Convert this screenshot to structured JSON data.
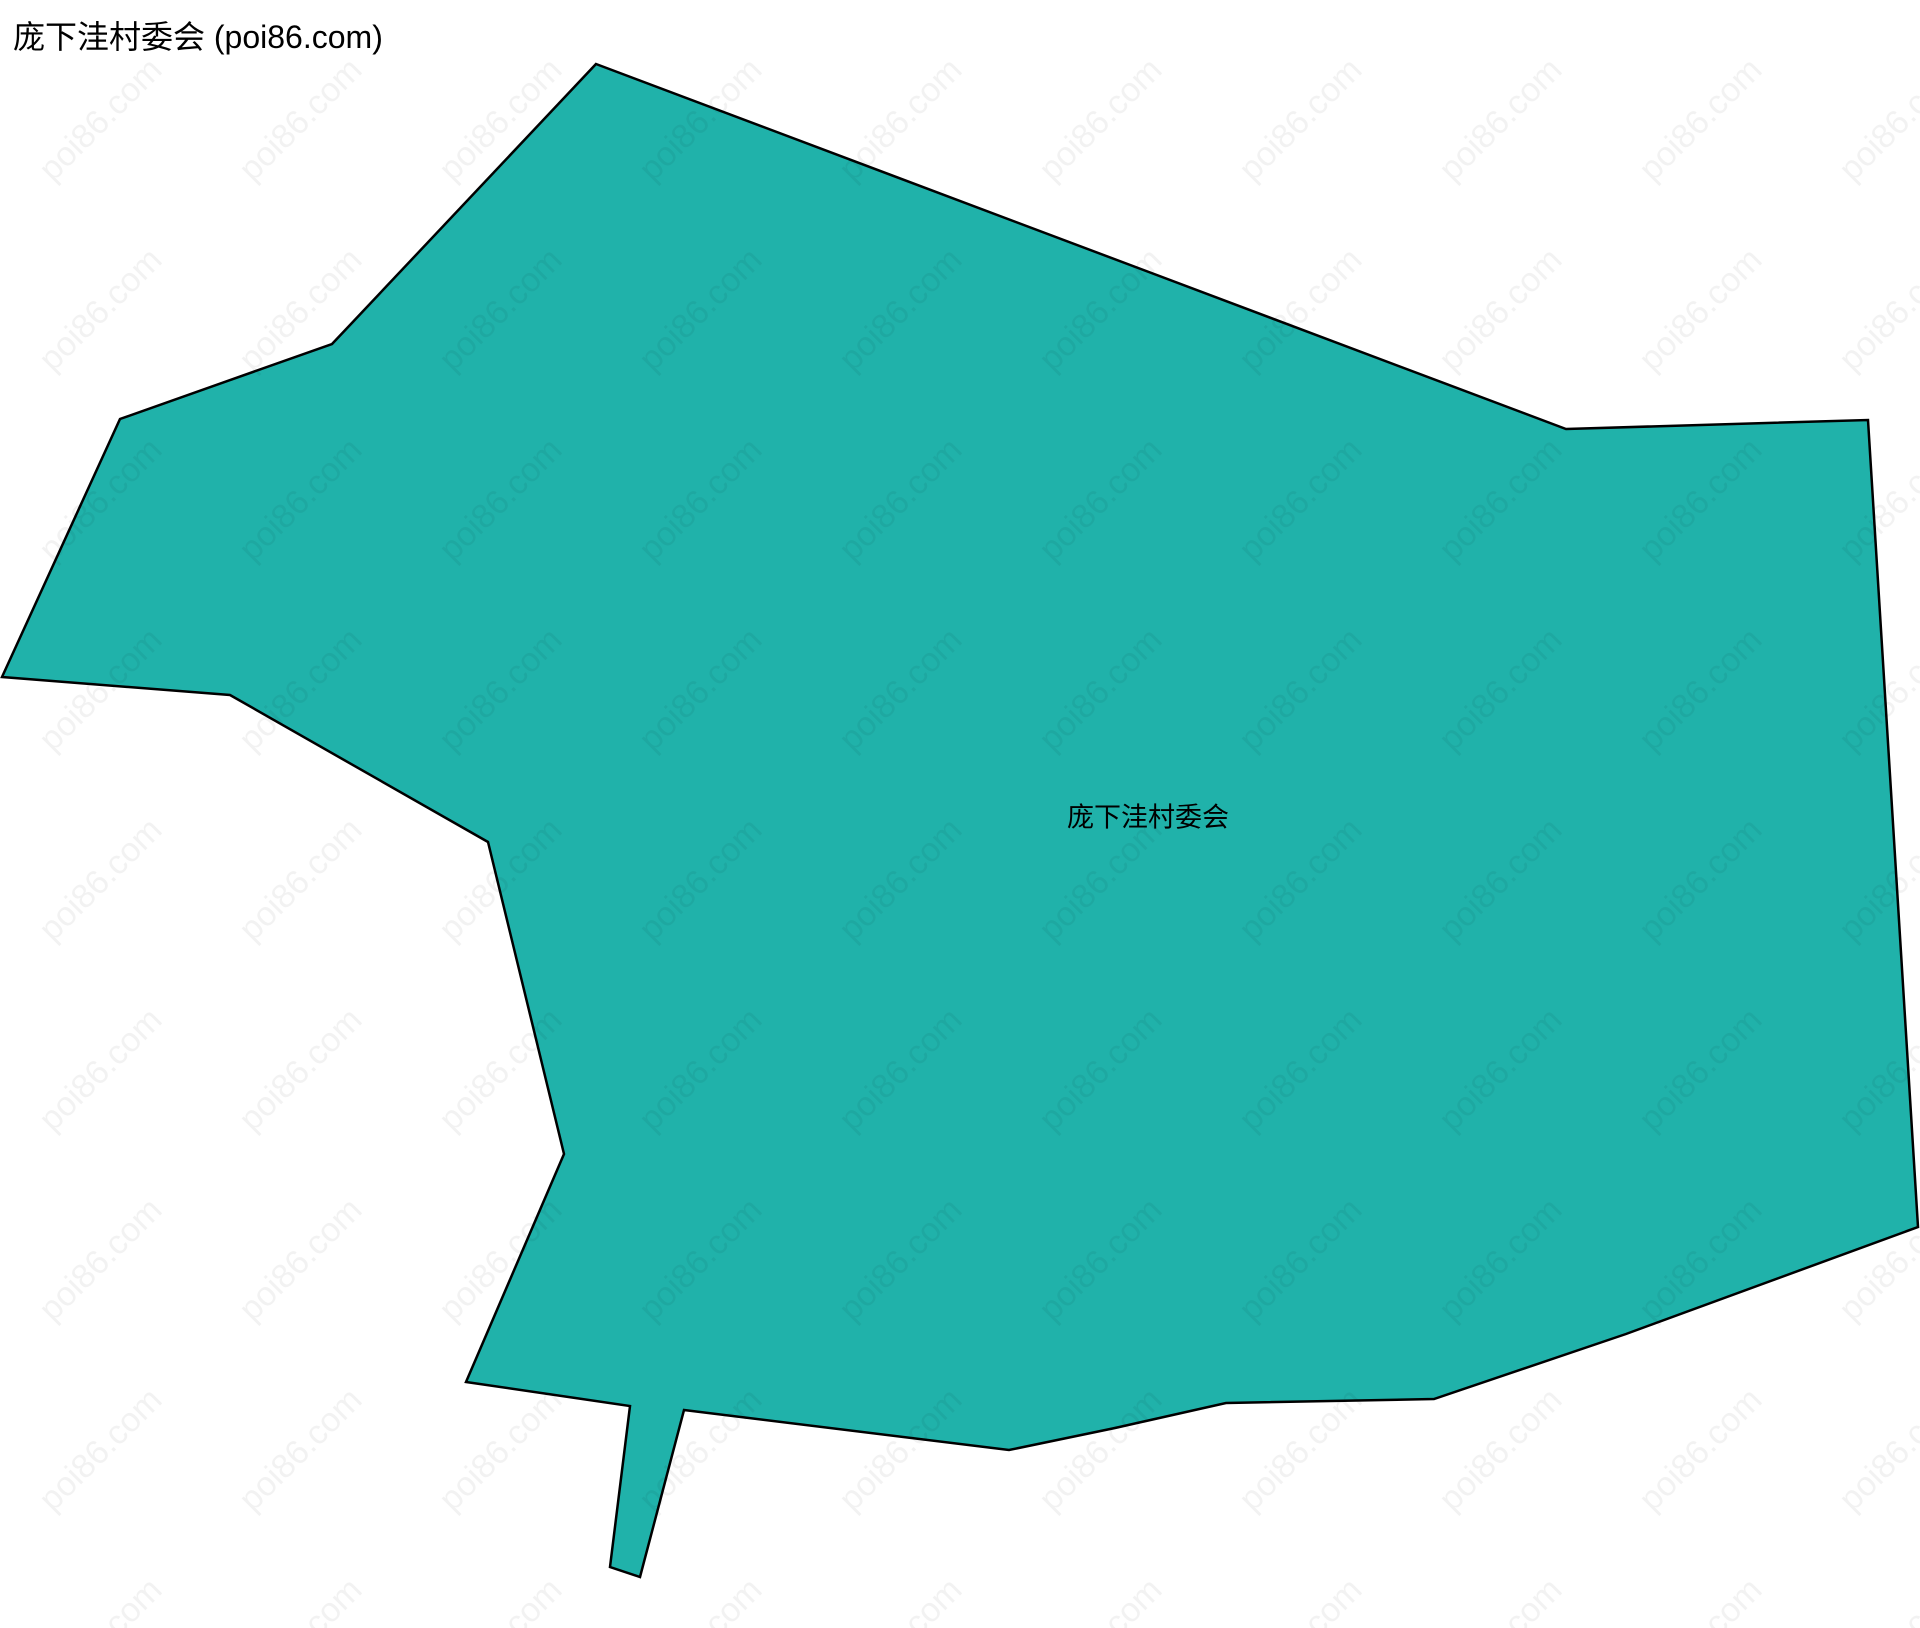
{
  "page": {
    "title": "庞下洼村委会 (poi86.com)",
    "background_color": "#ffffff"
  },
  "map": {
    "region_label": "庞下洼村委会",
    "fill_color": "#20b2aa",
    "stroke_color": "#000000",
    "stroke_width": 2.5,
    "label_position": {
      "x": 1148,
      "y": 815
    },
    "polygon_points": [
      [
        596,
        64
      ],
      [
        1566,
        429
      ],
      [
        1868,
        420
      ],
      [
        1918,
        1227
      ],
      [
        1626,
        1334
      ],
      [
        1434,
        1399
      ],
      [
        1226,
        1403
      ],
      [
        1115,
        1428
      ],
      [
        1009,
        1450
      ],
      [
        684,
        1410
      ],
      [
        640,
        1577
      ],
      [
        610,
        1567
      ],
      [
        630,
        1406
      ],
      [
        466,
        1382
      ],
      [
        564,
        1154
      ],
      [
        488,
        842
      ],
      [
        230,
        695
      ],
      [
        2,
        677
      ],
      [
        120,
        419
      ],
      [
        332,
        344
      ],
      [
        350,
        325
      ]
    ]
  },
  "watermark": {
    "text": "poi86.com",
    "color": "rgba(0,0,0,0.05)",
    "angle_deg": -45,
    "grid": {
      "x_start": 33,
      "y_start": 163,
      "x_step": 200,
      "y_step": 190,
      "cols": 10,
      "rows": 9
    }
  }
}
